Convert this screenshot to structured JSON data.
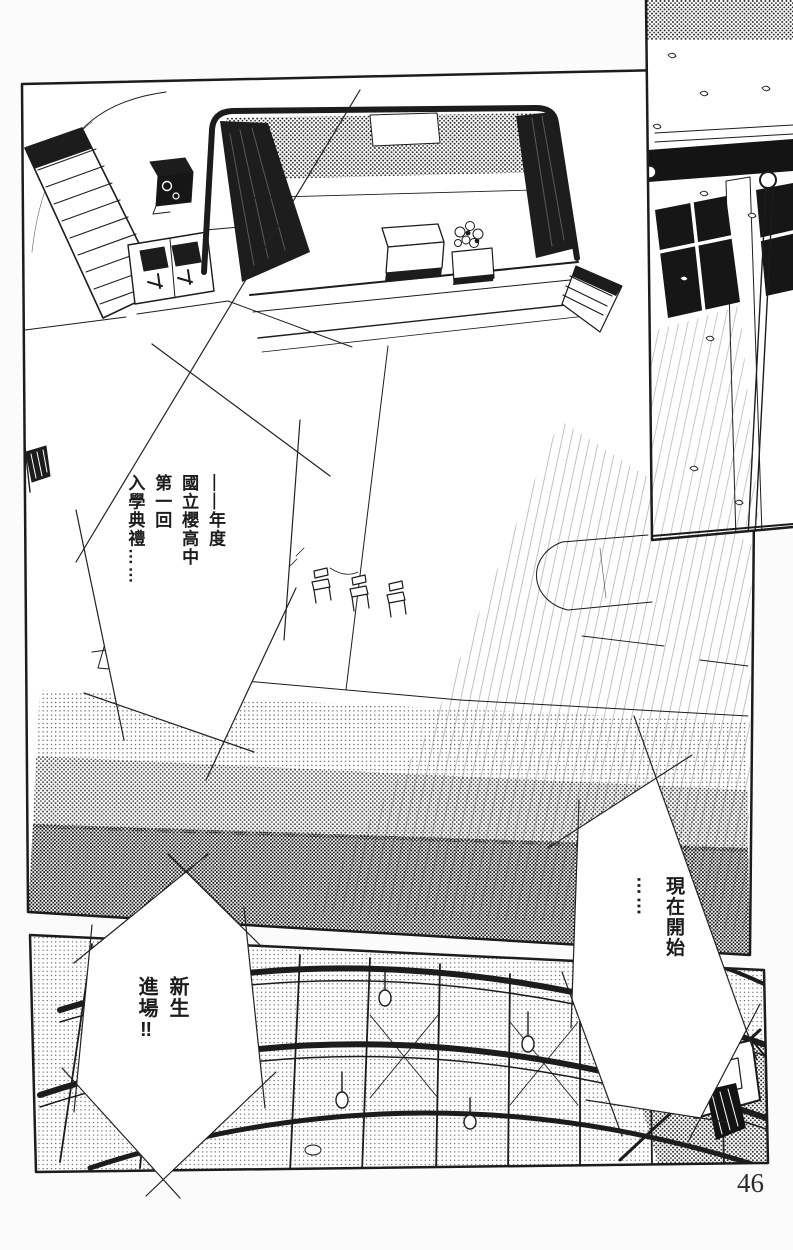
{
  "page": {
    "number": "46"
  },
  "bubbles": {
    "ceremony": "——年度\n國立櫻高中\n第一回\n入學典禮……",
    "now_start": "現在開始\n……",
    "new_students": "新生\n進場‼"
  },
  "colors": {
    "ink": "#1c1c1c",
    "paper": "#fbfbfb"
  }
}
